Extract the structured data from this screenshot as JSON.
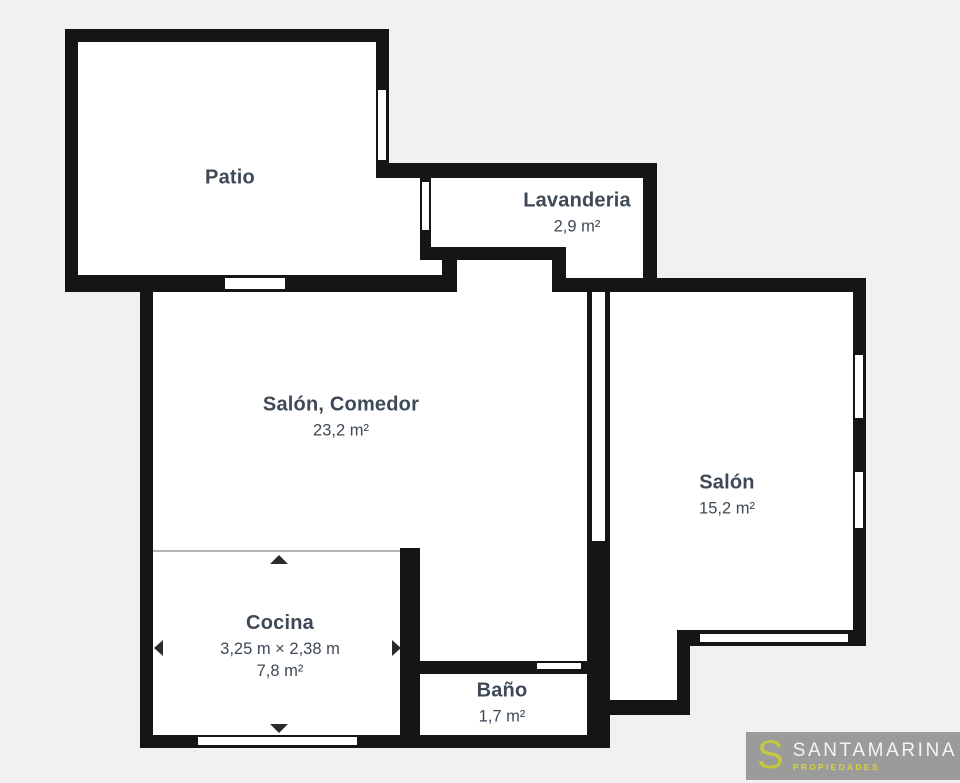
{
  "colors": {
    "exterior": "#f1f1f2",
    "wall": "#151515",
    "room_fill": "#ffffff",
    "label_text": "#3d4956",
    "measure_line": "#b5b5b5",
    "logo_box": "#9b9b9b",
    "logo_initial": "#c4c83e",
    "logo_brand": "#f4f4f4",
    "logo_tagline": "#d6d53a"
  },
  "rooms": {
    "patio": {
      "name": "Patio"
    },
    "lavanderia": {
      "name": "Lavanderia",
      "area": "2,9 m²"
    },
    "salon_comedor": {
      "name": "Salón, Comedor",
      "area": "23,2 m²"
    },
    "salon": {
      "name": "Salón",
      "area": "15,2 m²"
    },
    "cocina": {
      "name": "Cocina",
      "dimensions": "3,25 m × 2,38 m",
      "area": "7,8 m²"
    },
    "bano": {
      "name": "Baño",
      "area": "1,7 m²"
    }
  },
  "logo": {
    "initial": "S",
    "brand": "SANTAMARINA",
    "tagline": "PROPIEDADES"
  }
}
